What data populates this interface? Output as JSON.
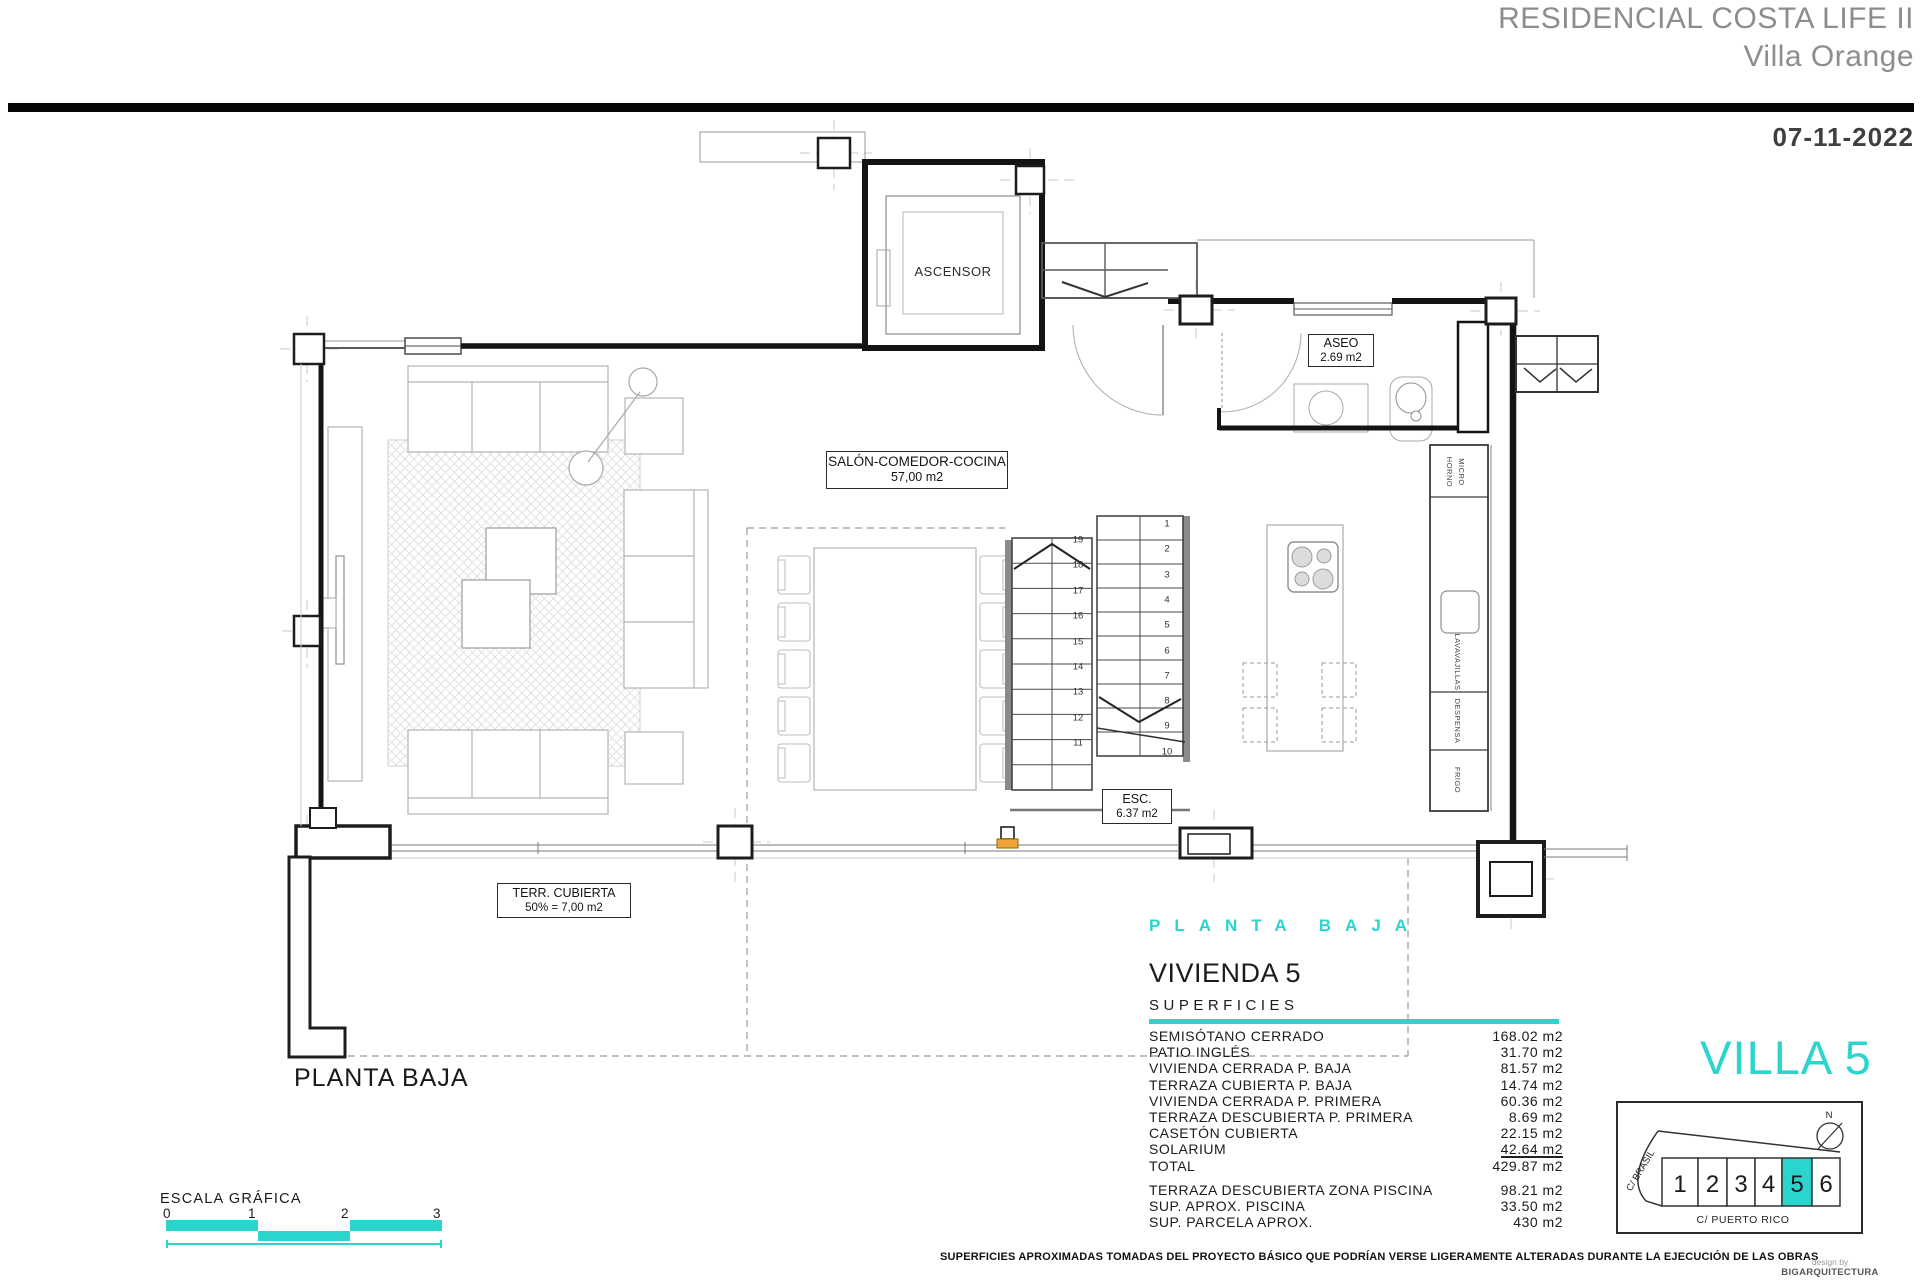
{
  "colors": {
    "accent": "#2BD5CE",
    "marker": "#F2A33C"
  },
  "header": {
    "project": "RESIDENCIAL COSTA LIFE II",
    "subtitle": "Villa Orange",
    "date": "07-11-2022"
  },
  "plan": {
    "ascensor": "ASCENSOR",
    "salon": {
      "title": "SALÓN-COMEDOR-COCINA",
      "area": "57,00 m2"
    },
    "aseo": {
      "title": "ASEO",
      "area": "2.69 m2"
    },
    "esc": {
      "title": "ESC.",
      "area": "6.37 m2"
    },
    "terraza": {
      "title": "TERR. CUBIERTA",
      "area": "50% = 7,00 m2"
    },
    "caption": "PLANTA BAJA",
    "appliances": [
      "HORNO",
      "MICRO",
      "LAVAVAJILLAS",
      "DESPENSA",
      "FRIGO"
    ],
    "stairs": {
      "left_flight": [
        "19",
        "18",
        "17",
        "16",
        "15",
        "14",
        "13",
        "12",
        "11"
      ],
      "right_flight": [
        "1",
        "2",
        "3",
        "4",
        "5",
        "6",
        "7",
        "8",
        "9",
        "10"
      ]
    }
  },
  "summary": {
    "floor_title": "PLANTA BAJA",
    "heading": "VIVIENDA 5",
    "subheading": "SUPERFICIES",
    "rows": [
      {
        "label": "SEMISÓTANO CERRADO",
        "value": "168.02 m2"
      },
      {
        "label": "PATIO INGLÉS",
        "value": "31.70 m2"
      },
      {
        "label": "VIVIENDA CERRADA P. BAJA",
        "value": "81.57 m2"
      },
      {
        "label": "TERRAZA CUBIERTA P. BAJA",
        "value": "14.74 m2"
      },
      {
        "label": "VIVIENDA CERRADA P. PRIMERA",
        "value": "60.36 m2"
      },
      {
        "label": "TERRAZA DESCUBIERTA P. PRIMERA",
        "value": "8.69 m2"
      },
      {
        "label": "CASETÓN CUBIERTA",
        "value": "22.15 m2"
      },
      {
        "label": "SOLARIUM",
        "value": "42.64 m2",
        "underline": true
      },
      {
        "label": "TOTAL",
        "value": "429.87 m2"
      }
    ],
    "extra_rows": [
      {
        "label": "TERRAZA DESCUBIERTA  ZONA PISCINA",
        "value": "98.21 m2"
      },
      {
        "label": "SUP.  APROX.  PISCINA",
        "value": "33.50 m2"
      },
      {
        "label": "SUP. PARCELA APROX.",
        "value": "430 m2"
      }
    ]
  },
  "villa5": {
    "title": "VILLA 5",
    "north": "N",
    "street_left": "C/ BRASIL",
    "street_bottom": "C/ PUERTO RICO",
    "plots": [
      "1",
      "2",
      "3",
      "4",
      "5",
      "6"
    ],
    "selected": "5"
  },
  "scale": {
    "title": "ESCALA GRÁFICA",
    "ticks": [
      "0",
      "1",
      "2",
      "3"
    ]
  },
  "footer": {
    "disclaimer": "SUPERFICIES APROXIMADAS TOMADAS DEL PROYECTO BÁSICO QUE PODRÍAN VERSE LIGERAMENTE ALTERADAS DURANTE LA EJECUCIÓN DE LAS OBRAS",
    "design_by": "design by",
    "studio": "BIGARQUITECTURA"
  }
}
